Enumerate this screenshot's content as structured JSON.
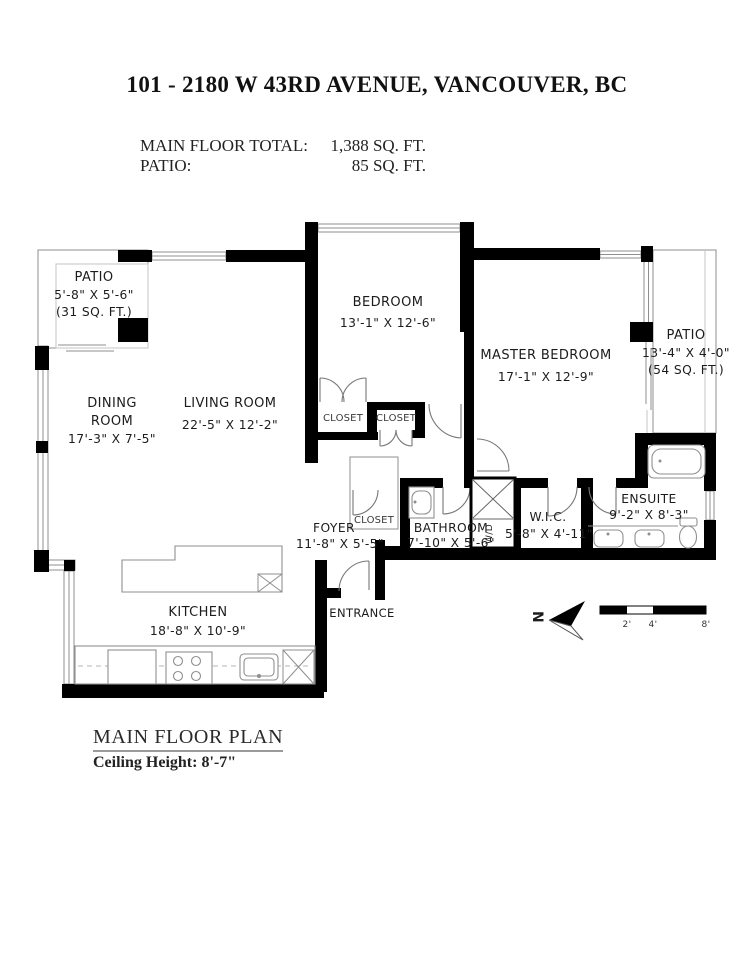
{
  "header": {
    "title": "101 - 2180 W 43RD AVENUE, VANCOUVER, BC",
    "stats": [
      {
        "label": "MAIN FLOOR TOTAL:",
        "value": "1,388 SQ. FT."
      },
      {
        "label": "PATIO:",
        "value": "85 SQ. FT."
      }
    ]
  },
  "rooms": {
    "patio_left": {
      "name": "PATIO",
      "dims": "5'-8\" X 5'-6\"",
      "area": "(31 SQ. FT.)"
    },
    "dining": {
      "line1": "DINING",
      "line2": "ROOM",
      "dims": "17'-3\" X 7'-5\""
    },
    "living": {
      "name": "LIVING ROOM",
      "dims": "22'-5\" X 12'-2\""
    },
    "bedroom": {
      "name": "BEDROOM",
      "dims": "13'-1\" X 12'-6\""
    },
    "master": {
      "name": "MASTER BEDROOM",
      "dims": "17'-1\" X 12'-9\""
    },
    "patio_right": {
      "name": "PATIO",
      "dims": "13'-4\" X 4'-0\"",
      "area": "(54 SQ. FT.)"
    },
    "foyer": {
      "name": "FOYER",
      "dims": "11'-8\" X 5'-5\""
    },
    "bathroom": {
      "name": "BATHROOM",
      "dims": "7'-10\" X 5'-6\""
    },
    "wic": {
      "name": "W.I.C.",
      "dims": "5'-8\" X 4'-11\""
    },
    "ensuite": {
      "name": "ENSUITE",
      "dims": "9'-2\" X 8'-3\""
    },
    "kitchen": {
      "name": "KITCHEN",
      "dims": "18'-8\" X 10'-9\""
    },
    "labels": {
      "closet": "CLOSET",
      "wd": "W/D",
      "entrance": "ENTRANCE"
    }
  },
  "compass": {
    "north": "N"
  },
  "scale_bar": {
    "ticks": [
      "2'",
      "4'",
      "8'"
    ]
  },
  "footer": {
    "plan_name": "MAIN FLOOR PLAN",
    "ceiling": "Ceiling Height: 8'-7\""
  },
  "colors": {
    "wall": "#000000",
    "thin_line": "#8f8f8f",
    "text": "#1c1c1c"
  }
}
